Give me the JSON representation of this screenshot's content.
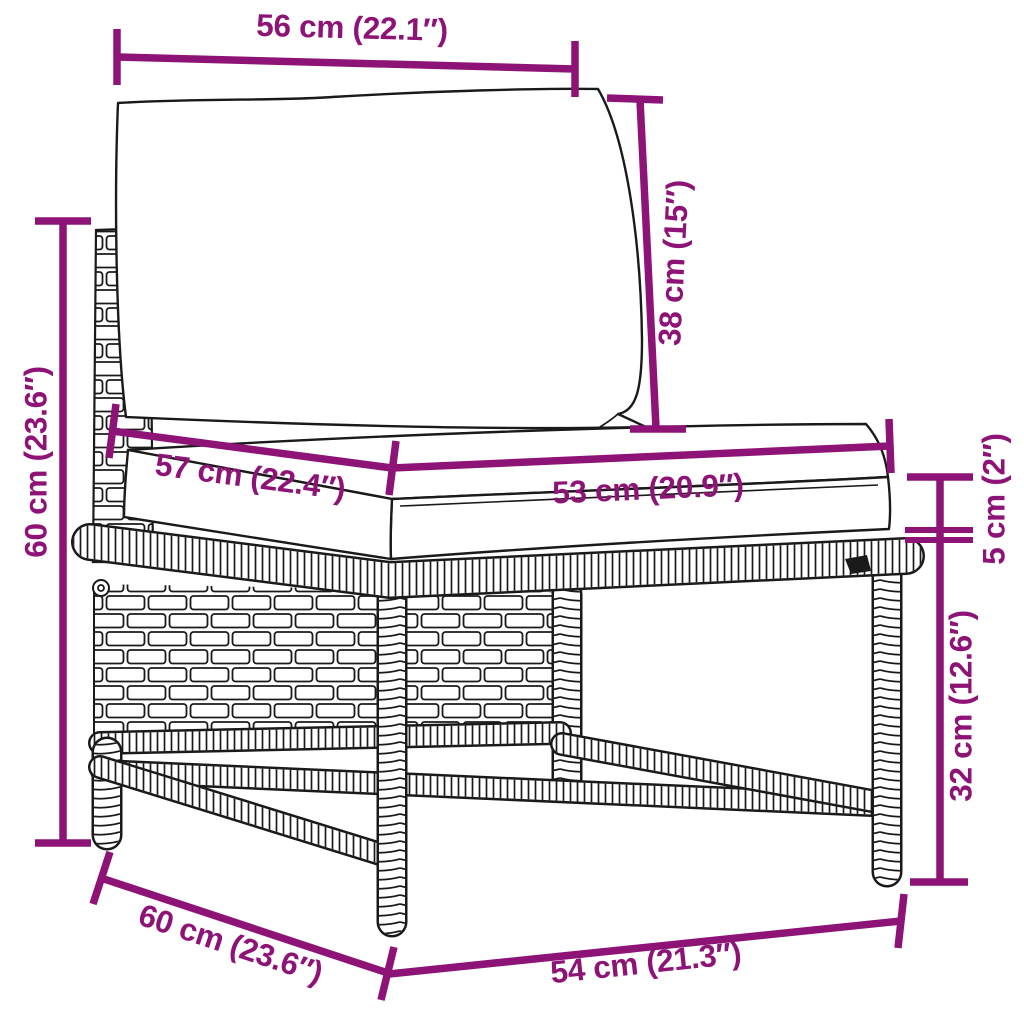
{
  "diagram": {
    "type": "product-dimension-diagram",
    "colors": {
      "dimension": "#8E1377",
      "outline": "#1a1a1a",
      "background": "#ffffff"
    },
    "dimensions": {
      "back_cushion_width": "56 cm (22.1″)",
      "back_cushion_height": "38 cm (15″)",
      "seat_depth": "57 cm (22.4″)",
      "seat_cushion_width": "53 cm (20.9″)",
      "seat_cushion_thickness": "5 cm (2″)",
      "total_height": "60 cm (23.6″)",
      "frame_height": "32 cm (12.6″)",
      "base_depth": "60 cm (23.6″)",
      "base_width": "54 cm (21.3″)"
    }
  }
}
